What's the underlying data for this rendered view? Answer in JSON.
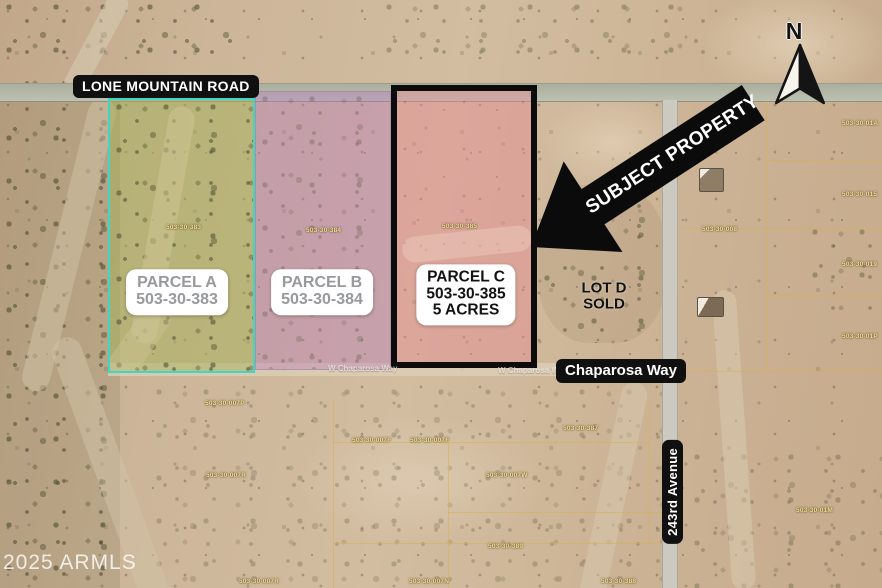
{
  "roads": {
    "lone_mountain": "LONE MOUNTAIN ROAD",
    "chaparosa": "Chaparosa Way",
    "avenue_243": "243rd Avenue"
  },
  "faint_road_labels": [
    {
      "text": "W Chaparosa Way"
    },
    {
      "text": "W Chaparosa Wa"
    }
  ],
  "parcels": {
    "a": {
      "name": "PARCEL A",
      "apn": "503-30-383"
    },
    "b": {
      "name": "PARCEL B",
      "apn": "503-30-384"
    },
    "c": {
      "name": "PARCEL C",
      "apn": "503-30-385",
      "size": "5 ACRES"
    },
    "d": {
      "name": "LOT D",
      "status": "SOLD"
    }
  },
  "callout": {
    "label": "SUBJECT PROPERTY"
  },
  "compass": {
    "north": "N"
  },
  "watermark": "2025 ARMLS",
  "gis_labels": [
    {
      "text": "503-30-383"
    },
    {
      "text": "503-30-384"
    },
    {
      "text": "503-30-385"
    },
    {
      "text": "503-30-01A"
    },
    {
      "text": "503-30-015"
    },
    {
      "text": "503-30-019"
    },
    {
      "text": "503-30-01P"
    },
    {
      "text": "503-30-008"
    },
    {
      "text": "503-30-01M"
    },
    {
      "text": "503-30-007P"
    },
    {
      "text": "503-30-007F"
    },
    {
      "text": "503-30-007F"
    },
    {
      "text": "503-30-007W"
    },
    {
      "text": "503-30-007R"
    },
    {
      "text": "503-30-387"
    },
    {
      "text": "503-30-389"
    },
    {
      "text": "503-30-007R"
    },
    {
      "text": "503-30-007N"
    },
    {
      "text": "503-30-388"
    }
  ],
  "colors": {
    "desert_base": "#CBB297",
    "road_gray": "#B7BCAC",
    "parcel_a_border": "#3BD8C6",
    "parcel_a_fill": "rgba(187,198,106,0.42)",
    "parcel_b_fill": "rgba(182,121,188,0.40)",
    "parcel_c_fill": "rgba(232,136,148,0.44)",
    "parcel_c_border": "#0C0C0C",
    "label_pill_bg": "#101010",
    "label_pill_text": "#FFFFFF",
    "parcel_ab_label_text": "#97999C",
    "gis_line": "#D8B14A",
    "gis_text": "#EFE098"
  }
}
